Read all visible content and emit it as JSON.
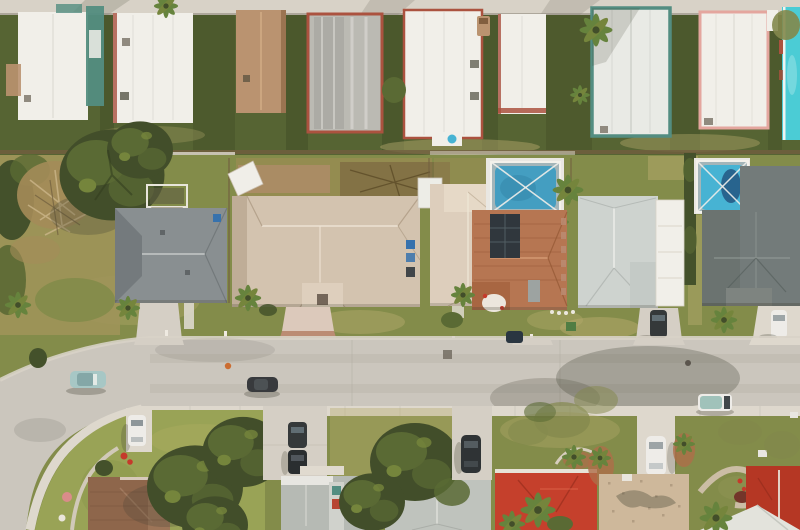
{
  "scene": {
    "description": "Top-down aerial drone photograph of a Florida suburban neighborhood: a mobile-home park row at top, a row of single-family houses with two screened swimming pools in the middle, a curving residential street with parked cars, and another row of houses with mature trees at the bottom.",
    "regions": {
      "top_road": "Concrete lane at top edge of mobile home park",
      "mobile_home_park": "Row of nine mobile homes with white, tan, metal-gray, teal-trim, pink-trim and cyan roofs separated by dark green lawns and palms",
      "suburban_lots": "Middle row of houses: gray hip roof, two large beige tile roofs, terracotta roof with solar panel, light gray roof with white garage, dark gray shingle roof; two screened pool enclosures; scrub lot and large tree at left",
      "street": "Light asphalt street curving down at bottom-left, concrete gutters and sidewalk, tree shadows, parked cars",
      "bottom_houses": "Bottom row: brown shingle roof, two gray roofs, red tile roofs, speckled tan roof, driveways with cars, dense green trees and landscaped beds"
    },
    "objects": {
      "mobile_homes": 9,
      "middle_row_houses": 6,
      "bottom_row_houses": 7,
      "pools": 2,
      "cars": [
        "teal sedan on street",
        "dark sedan on street",
        "white-teal van on street",
        "dark sedan mid driveway",
        "small dark car mid driveway",
        "white car far-right driveway",
        "white car bottom-left driveway",
        "two dark cars bottom driveway",
        "dark car bottom driveway",
        "white car bottom-right driveway"
      ]
    }
  },
  "palette": {
    "concrete": "#d7d3c9",
    "asphalt": "#c9c6bf",
    "sidewalk": "#ddd9d0",
    "driveway": "#d4d0c7",
    "parkGrass": "#50602f",
    "parkGrassDark": "#3c4c24",
    "lawnGreen": "#7e8a47",
    "lawnBright": "#95a254",
    "dryGrass": "#b4a96c",
    "scrubTan": "#9c9258",
    "brushBrown": "#a18a56",
    "shrubDark": "#3d4d27",
    "treeDark": "#3b4926",
    "treeMid": "#546630",
    "treeLight": "#708339",
    "treeOlive": "#7e8649",
    "palmGreen": "#60803a",
    "roofWhite": "#f1f1ed",
    "roofWhiteDim": "#e4e4df",
    "metalRoof": "#b9bab5",
    "tanRoof": "#b8916f",
    "cyanRoof": "#44ccd8",
    "redTrim": "#a84e3c",
    "tealTrim": "#4d8b80",
    "pinkTrim": "#e3a59f",
    "roofGrayA": "#858d91",
    "roofGrayADark": "#6f777c",
    "roofBeige": "#d2c3b0",
    "roofBeigeDark": "#bdac97",
    "roofBeigeLight": "#dccfbe",
    "roofTerra": "#b47350",
    "roofTerraDark": "#8f5330",
    "solarDark": "#28313a",
    "roofGrayLight": "#cdd4d2",
    "roofDark": "#6e7879",
    "roofGrayB": "#b4bab6",
    "roofGrayB2": "#bdc3bf",
    "roofBrown": "#8a6248",
    "roofTan": "#ccb89c",
    "roofRed": "#c33b28",
    "roofRed2": "#b23120",
    "ridgeWhite": "#e6e8e4",
    "poolBlue": "#3d9dc3",
    "poolBlue2": "#40b2d6",
    "poolDeep": "#20608e",
    "screenGray": "#a0b5bb",
    "deckWhite": "#e9e9e5",
    "paverPink": "#dbc9bd",
    "paverRed": "#b98a72",
    "paverTan": "#c9bda6",
    "carTeal": "#a4c7c7",
    "carDark": "#2d3337",
    "carDark2": "#22282c",
    "carWhite": "#eeeeec",
    "glass": "#5a6a72",
    "shadow": "#3a3c2e",
    "fenceBrown": "#6b5a3c",
    "binBlue": "#2f6fae",
    "utilGreen": "#4a7a40",
    "flowerRed": "#c33527",
    "flowerPink": "#d98a8a",
    "mulchRed": "#ab6a46",
    "shrubMaroon": "#6e2f26",
    "hydrantOrange": "#c96a2e",
    "boulder": "#e9e6de",
    "tarpWhite": "#f0f0ec",
    "shedWhite": "#edefeb",
    "dirtGray": "#8c887e"
  }
}
